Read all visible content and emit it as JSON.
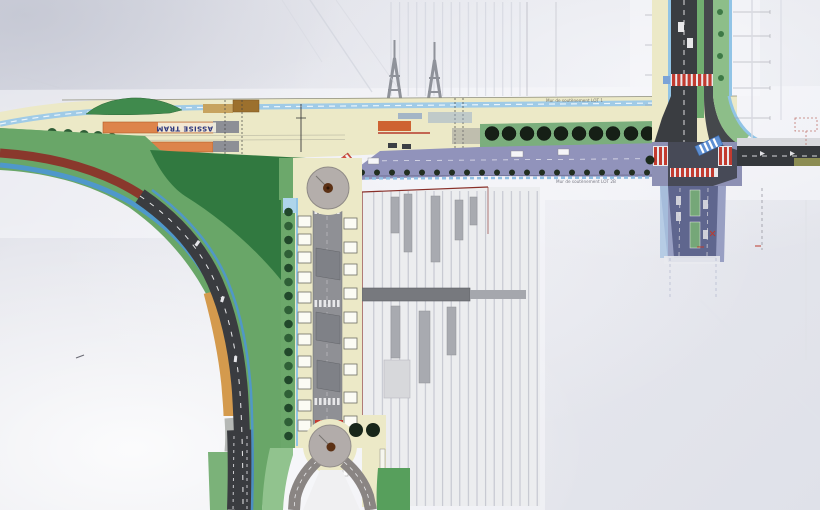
{
  "plan": {
    "labels": {
      "tram_bed": "ASSISE TRAM",
      "retaining_wall_north": "Mur de soutènement LOT 1",
      "retaining_wall_south": "Mur de soutènement LOT 2B"
    },
    "colors": {
      "paper": "#e4e5ec",
      "plan_cream": "#ece9c6",
      "grass_green": "#67a766",
      "dark_green": "#2f7a3e",
      "tram_platform_orange": "#e08348",
      "road_asphalt": "#3a3d41",
      "phase_overlay_purple": "#9193bd",
      "cycle_path_blue": "#4b97d4",
      "crosswalk_red": "#c63a2e",
      "station_outline_red": "#8c2f28",
      "earth_tan": "#d69a4a",
      "roundabout_gray": "#b2acaa"
    }
  }
}
